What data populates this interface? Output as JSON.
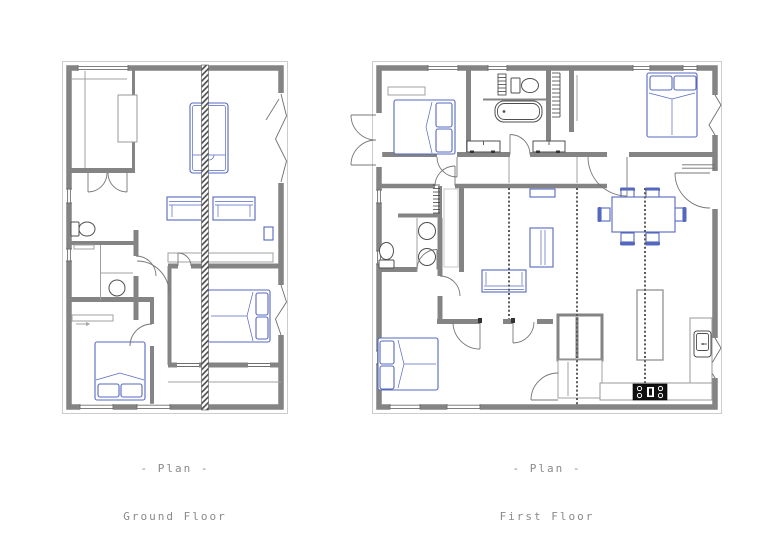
{
  "page": {
    "background_color": "#ffffff"
  },
  "colors": {
    "wall_gray": "#848484",
    "thin_line_gray": "#a0a0a0",
    "frame_gray": "#cccccc",
    "furniture_blue": "#5568c0",
    "fixture_gray": "#4f4f4f",
    "caption_gray": "#8a8a8a",
    "stove_black": "#111111"
  },
  "plans": [
    {
      "id": "ground-floor",
      "caption_line1": "- Plan -",
      "caption_line2": "Ground Floor",
      "visible_elements": [
        "exterior-walls",
        "windows",
        "structural-hatched-column",
        "bed",
        "two-sofas",
        "double-bed",
        "single-bed",
        "desk",
        "wc-toilet",
        "bathroom-sink",
        "interior-doors",
        "wardrobe-bands"
      ]
    },
    {
      "id": "first-floor",
      "caption_line1": "- Plan -",
      "caption_line2": "First Floor",
      "visible_elements": [
        "exterior-walls",
        "windows",
        "french-entry-doors",
        "three-double-beds",
        "bathtub",
        "two-toilets",
        "twin-basins",
        "towel-radiator",
        "two-radiators",
        "dining-table-six-chairs",
        "sofa",
        "sideboard",
        "wall-shelf",
        "wardrobe-hangers",
        "staircase-block",
        "kitchen-island",
        "kitchen-counters",
        "kitchen-sink",
        "stove",
        "ceiling-beam-dashed-lines"
      ]
    }
  ]
}
